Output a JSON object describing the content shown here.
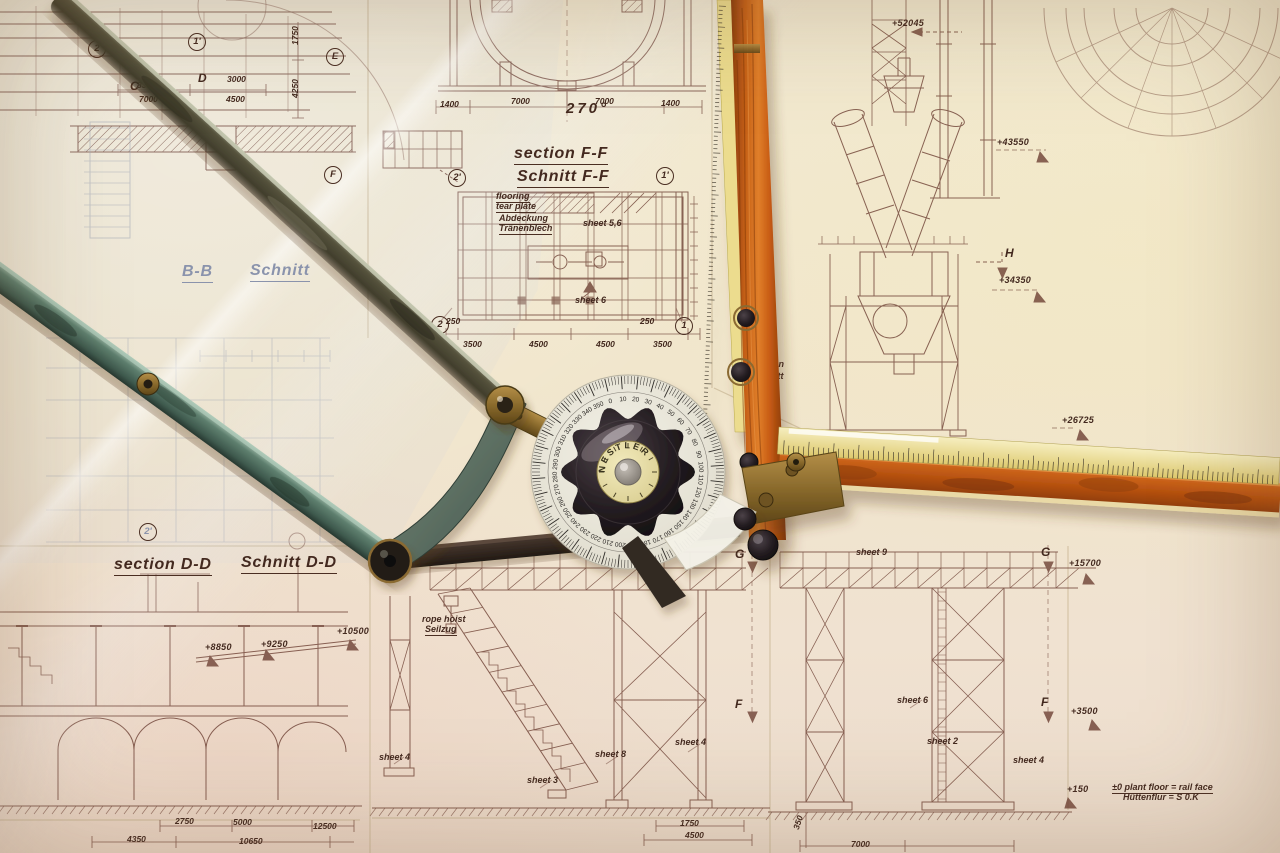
{
  "photo": {
    "paper_color": "#f0e6cf",
    "ink_color": "#6d4034",
    "accent_wood": "#c85c14",
    "accent_yellow": "#ead985",
    "accent_teal": "#5e7f6e"
  },
  "protractor": {
    "brand": "NESTLER",
    "degree_step": 10,
    "degrees": [
      0,
      10,
      20,
      30,
      40,
      50,
      60,
      70,
      80,
      90,
      100,
      110,
      120,
      130,
      140,
      150,
      160,
      170,
      180,
      190,
      200,
      210,
      220,
      230,
      240,
      250,
      260,
      270,
      280,
      290,
      300,
      310,
      320,
      330,
      340,
      350
    ]
  },
  "annotations": {
    "titles": [
      {
        "text": "section F-F",
        "x": 514,
        "y": 146
      },
      {
        "text": "Schnitt F-F",
        "x": 517,
        "y": 169
      },
      {
        "text": "section D-D",
        "x": 114,
        "y": 557
      },
      {
        "text": "Schnitt D-D",
        "x": 241,
        "y": 555
      },
      {
        "text": "B-B",
        "x": 182,
        "y": 264,
        "faint": true
      },
      {
        "text": "Schnitt",
        "x": 250,
        "y": 263,
        "faint": true
      }
    ],
    "notes": [
      {
        "text": "flooring",
        "x": 496,
        "y": 192,
        "underline": true
      },
      {
        "text": "tear plate",
        "x": 496,
        "y": 202,
        "underline": true
      },
      {
        "text": "Abdeckung",
        "x": 499,
        "y": 214,
        "underline": true
      },
      {
        "text": "Tränenblech",
        "x": 499,
        "y": 224,
        "underline": true
      },
      {
        "text": "sheet 5,6",
        "x": 583,
        "y": 219
      },
      {
        "text": "sheet 6",
        "x": 575,
        "y": 296
      },
      {
        "text": "rope hoist",
        "x": 422,
        "y": 615
      },
      {
        "text": "Seilzug",
        "x": 425,
        "y": 625,
        "underline": true
      },
      {
        "text": "sheet 9",
        "x": 856,
        "y": 548
      },
      {
        "text": "sheet 6",
        "x": 897,
        "y": 696
      },
      {
        "text": "sheet 2",
        "x": 927,
        "y": 737
      },
      {
        "text": "sheet 4",
        "x": 1013,
        "y": 756
      },
      {
        "text": "sheet 4",
        "x": 675,
        "y": 738
      },
      {
        "text": "sheet 8",
        "x": 595,
        "y": 750
      },
      {
        "text": "sheet 3",
        "x": 527,
        "y": 776
      },
      {
        "text": "sheet 4",
        "x": 379,
        "y": 753
      },
      {
        "text": "position",
        "x": 749,
        "y": 360
      },
      {
        "text": "Schnitt",
        "x": 753,
        "y": 372
      },
      {
        "text": "±0 plant floor = rail face",
        "x": 1112,
        "y": 783,
        "underline": true
      },
      {
        "text": "Hüttenflur = S 0.K",
        "x": 1123,
        "y": 793
      }
    ],
    "elevations": [
      {
        "text": "+52045",
        "x": 892,
        "y": 19
      },
      {
        "text": "+43550",
        "x": 997,
        "y": 138
      },
      {
        "text": "+34350",
        "x": 999,
        "y": 276
      },
      {
        "text": "+26725",
        "x": 1062,
        "y": 416
      },
      {
        "text": "+15700",
        "x": 1069,
        "y": 559
      },
      {
        "text": "+3500",
        "x": 1071,
        "y": 707
      },
      {
        "text": "+150",
        "x": 1067,
        "y": 785
      },
      {
        "text": "+10500",
        "x": 337,
        "y": 627
      },
      {
        "text": "+9250",
        "x": 261,
        "y": 640
      },
      {
        "text": "+8850",
        "x": 205,
        "y": 643
      }
    ],
    "markers": [
      {
        "text": "C",
        "x": 130,
        "y": 80
      },
      {
        "text": "D",
        "x": 198,
        "y": 72
      },
      {
        "text": "E",
        "x": 326,
        "y": 48,
        "circled": true
      },
      {
        "text": "F",
        "x": 324,
        "y": 166,
        "circled": true
      },
      {
        "text": "2",
        "x": 88,
        "y": 40,
        "circled": true
      },
      {
        "text": "1'",
        "x": 188,
        "y": 33,
        "circled": true
      },
      {
        "text": "2'",
        "x": 448,
        "y": 169,
        "circled": true
      },
      {
        "text": "1'",
        "x": 656,
        "y": 167,
        "circled": true
      },
      {
        "text": "2",
        "x": 431,
        "y": 316,
        "circled": true
      },
      {
        "text": "1",
        "x": 675,
        "y": 317,
        "circled": true
      },
      {
        "text": "2'",
        "x": 139,
        "y": 523,
        "circled": true,
        "faint": true
      },
      {
        "text": "G",
        "x": 735,
        "y": 548
      },
      {
        "text": "G",
        "x": 1041,
        "y": 546
      },
      {
        "text": "F",
        "x": 735,
        "y": 698
      },
      {
        "text": "F",
        "x": 1041,
        "y": 696
      },
      {
        "text": "H",
        "x": 1005,
        "y": 247
      }
    ],
    "dimensions": [
      {
        "text": "270°",
        "x": 566,
        "y": 101,
        "large": true
      },
      {
        "text": "1400",
        "x": 440,
        "y": 100
      },
      {
        "text": "7000",
        "x": 511,
        "y": 97
      },
      {
        "text": "7000",
        "x": 595,
        "y": 97
      },
      {
        "text": "1400",
        "x": 661,
        "y": 99
      },
      {
        "text": "8310",
        "x": 137,
        "y": 81
      },
      {
        "text": "3000",
        "x": 227,
        "y": 75
      },
      {
        "text": "7000",
        "x": 139,
        "y": 95
      },
      {
        "text": "4500",
        "x": 226,
        "y": 95
      },
      {
        "text": "1750",
        "x": 291,
        "y": 45,
        "rot": -90
      },
      {
        "text": "4250",
        "x": 291,
        "y": 98,
        "rot": -90
      },
      {
        "text": "250",
        "x": 446,
        "y": 317
      },
      {
        "text": "3500",
        "x": 463,
        "y": 340
      },
      {
        "text": "4500",
        "x": 529,
        "y": 340
      },
      {
        "text": "4500",
        "x": 596,
        "y": 340
      },
      {
        "text": "3500",
        "x": 653,
        "y": 340
      },
      {
        "text": "250",
        "x": 640,
        "y": 317
      },
      {
        "text": "2750",
        "x": 175,
        "y": 817
      },
      {
        "text": "5000",
        "x": 233,
        "y": 818
      },
      {
        "text": "12500",
        "x": 313,
        "y": 822
      },
      {
        "text": "4350",
        "x": 127,
        "y": 835
      },
      {
        "text": "10650",
        "x": 239,
        "y": 837
      },
      {
        "text": "1750",
        "x": 680,
        "y": 819
      },
      {
        "text": "4500",
        "x": 685,
        "y": 831
      },
      {
        "text": "350",
        "x": 792,
        "y": 828,
        "rot": -72
      },
      {
        "text": "7000",
        "x": 851,
        "y": 840
      }
    ]
  }
}
